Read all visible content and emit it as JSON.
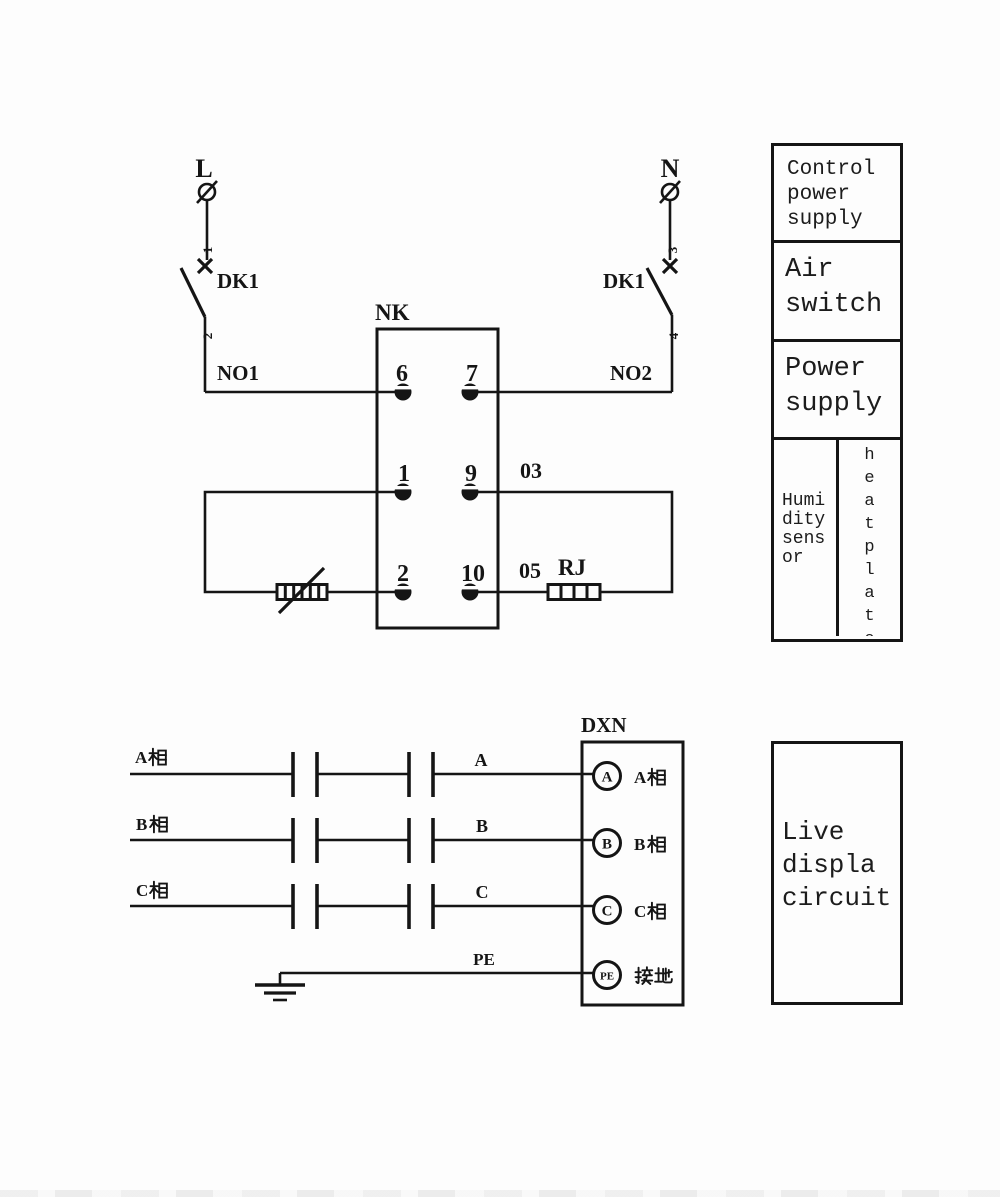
{
  "colors": {
    "ink": "#151515",
    "paper": "#fdfdfd"
  },
  "top_circuit": {
    "l_label": "L",
    "n_label": "N",
    "dk1_left": "DK1",
    "dk1_right": "DK1",
    "pole_1": "1",
    "pole_2": "2",
    "pole_3": "3",
    "pole_4": "4",
    "no1": "NO1",
    "no2": "NO2",
    "controller_name": "NK",
    "terminals": {
      "t6": "6",
      "t7": "7",
      "t1": "1",
      "t9": "9",
      "t2": "2",
      "t10": "10"
    },
    "wire03": "03",
    "wire05": "05",
    "heater_label": "RJ"
  },
  "legend_table": {
    "row1": "Control power supply",
    "row2": "Air switch",
    "row3": "Power supply",
    "humidity": "Humidity sensor",
    "heatplate": "heatplate"
  },
  "bottom_circuit": {
    "dxn": "DXN",
    "phase_a": "A相",
    "phase_b": "B相",
    "phase_c": "C相",
    "wire_a": "A",
    "wire_b": "B",
    "wire_c": "C",
    "wire_pe": "PE",
    "term_a": "A",
    "term_b": "B",
    "term_c": "C",
    "term_pe": "PE",
    "term_a_label": "A相",
    "term_b_label": "B相",
    "term_c_label": "C相",
    "term_pe_label": "接地"
  },
  "live_box": {
    "text": "Live displa circuit"
  }
}
